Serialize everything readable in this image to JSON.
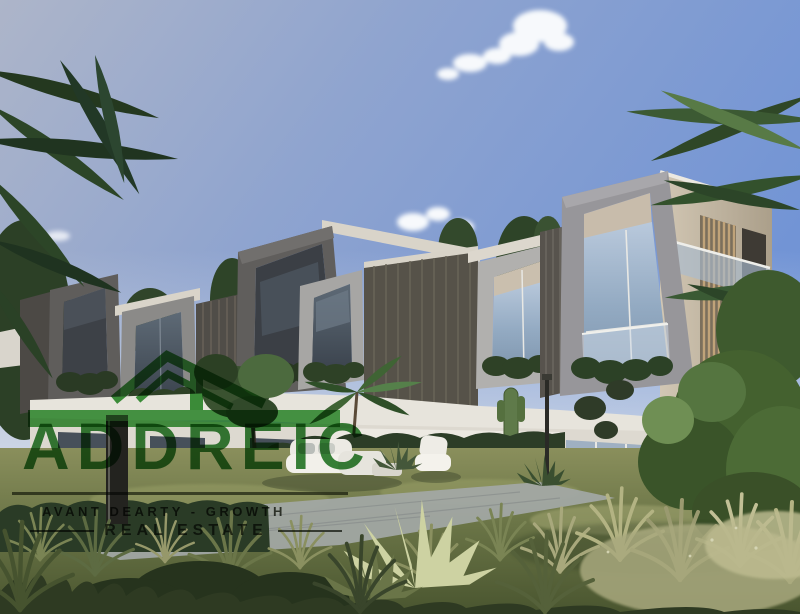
{
  "watermark": {
    "logo_icon": "house-roof-icon",
    "brand": "ADDREIC",
    "tagline": "AVANT   DEARTY - GROWTH",
    "subtitle": "REAL ESTATE",
    "logo_green": "#1e8a1e",
    "brand_green": "#0d6b0e",
    "dark_text": "#11180a"
  },
  "palette": {
    "sky_top_right": "#7093d6",
    "sky_top_left": "#abb4c9",
    "sky_horizon": "#d2dae6",
    "cloud_white": "#f6f8fb",
    "frame_dark_gray": "#504e4c",
    "frame_mid_gray": "#8b8a88",
    "frame_light_gray": "#b1b0ae",
    "louver_wall": "#565249",
    "beige_wall": "#c9bda9",
    "wood_slat": "#c0a379",
    "fascia_white": "#e9e7e0",
    "glass_blue": "#9db2c8",
    "hedge_green": "#2c3d27",
    "lawn_olive": "#6b7547",
    "tree_green": "#4e6b38",
    "grass_wheat": "#b3b383",
    "path_gray": "#a3a8a6"
  },
  "scene": {
    "subject": "row of modern geometric-framed townhouses in a landscaped garden",
    "foreground": "wild grasses, agave, hedges, white outdoor lounge furniture, stone path",
    "background": "blue sky with clouds, palm fronds at upper corners, trees"
  }
}
